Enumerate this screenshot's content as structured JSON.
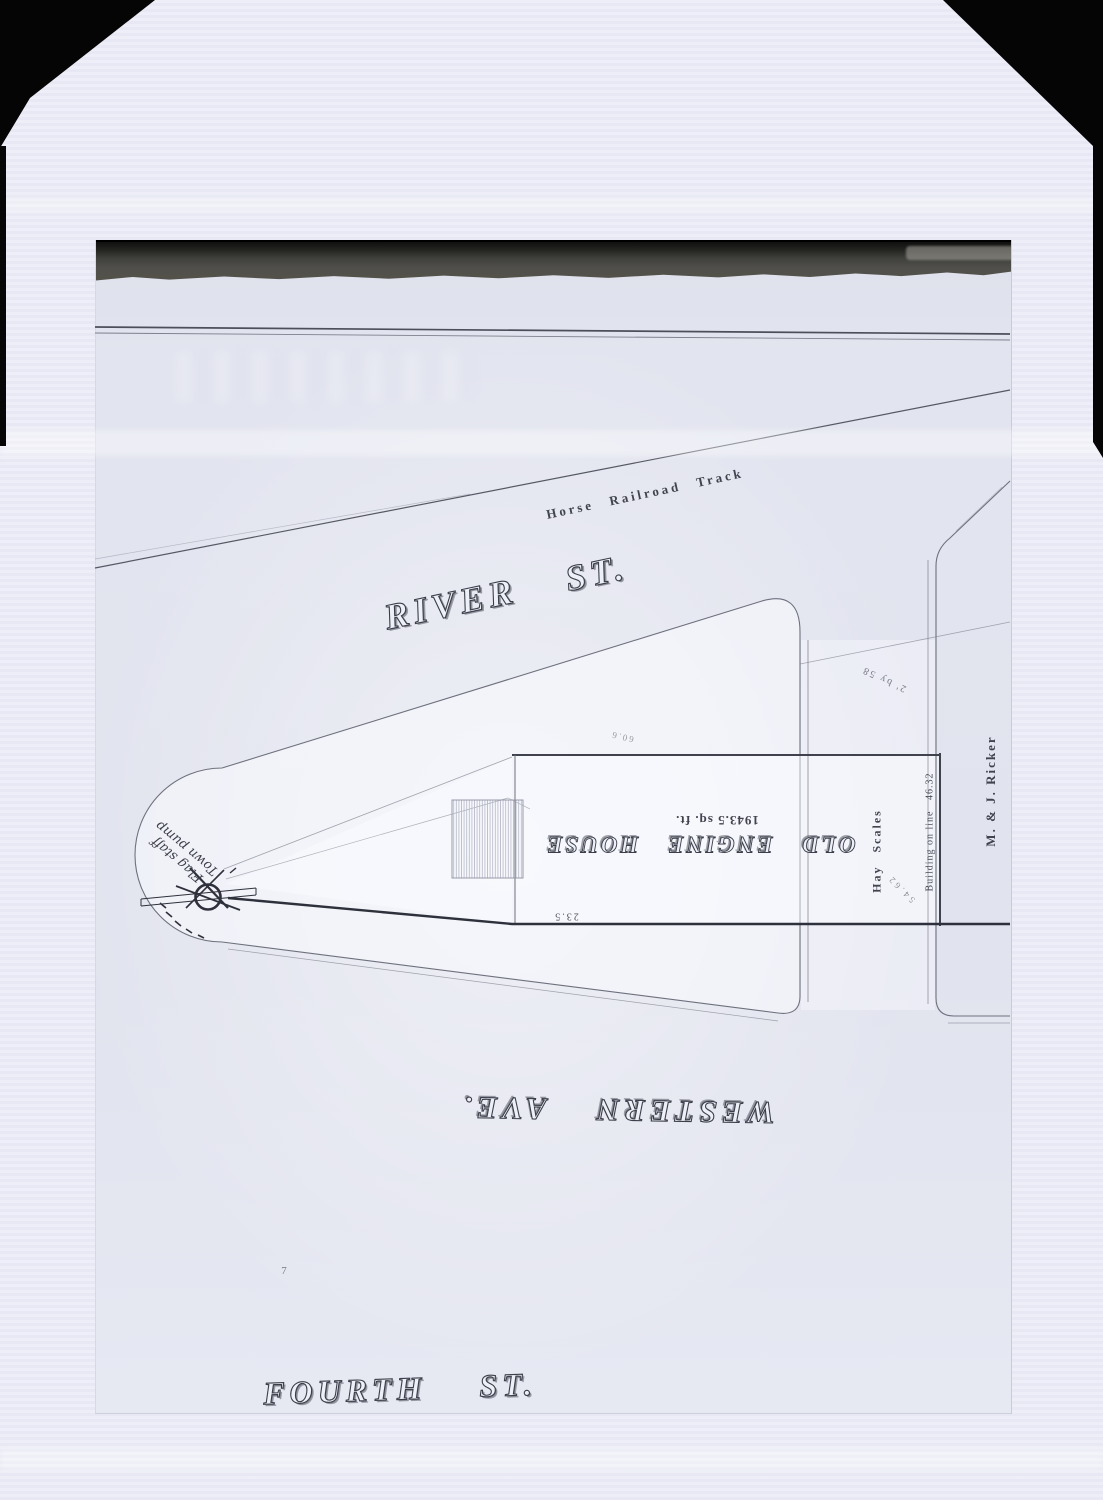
{
  "photo": {
    "streets": {
      "river": "RIVER ST.",
      "western": "WESTERN AVE.",
      "fourth": "FOURTH ST."
    },
    "railroad": {
      "label": "Horse Railroad Track"
    },
    "engine_house": {
      "name": "OLD ENGINE HOUSE",
      "area": "1943.5 sq. ft.",
      "front_dim": "23.5",
      "top_dim": "60.6"
    },
    "east_block": {
      "hay_scales": "Hay Scales",
      "building_on_line": "Building on line",
      "line_dim": "46.32",
      "owner": "M. & J. Ricker",
      "lumber_dim": "2' by 58",
      "diag_dim": "54.62"
    },
    "handwritten": {
      "line1": "Flag staff",
      "line2": "Town pump"
    },
    "misc_mark": "7",
    "colors": {
      "background": "#050505",
      "paper": "#ecedf7",
      "sheet": "#e2e4ee",
      "ink": "#3d414c",
      "torn_band": "#4e4e4c"
    }
  }
}
